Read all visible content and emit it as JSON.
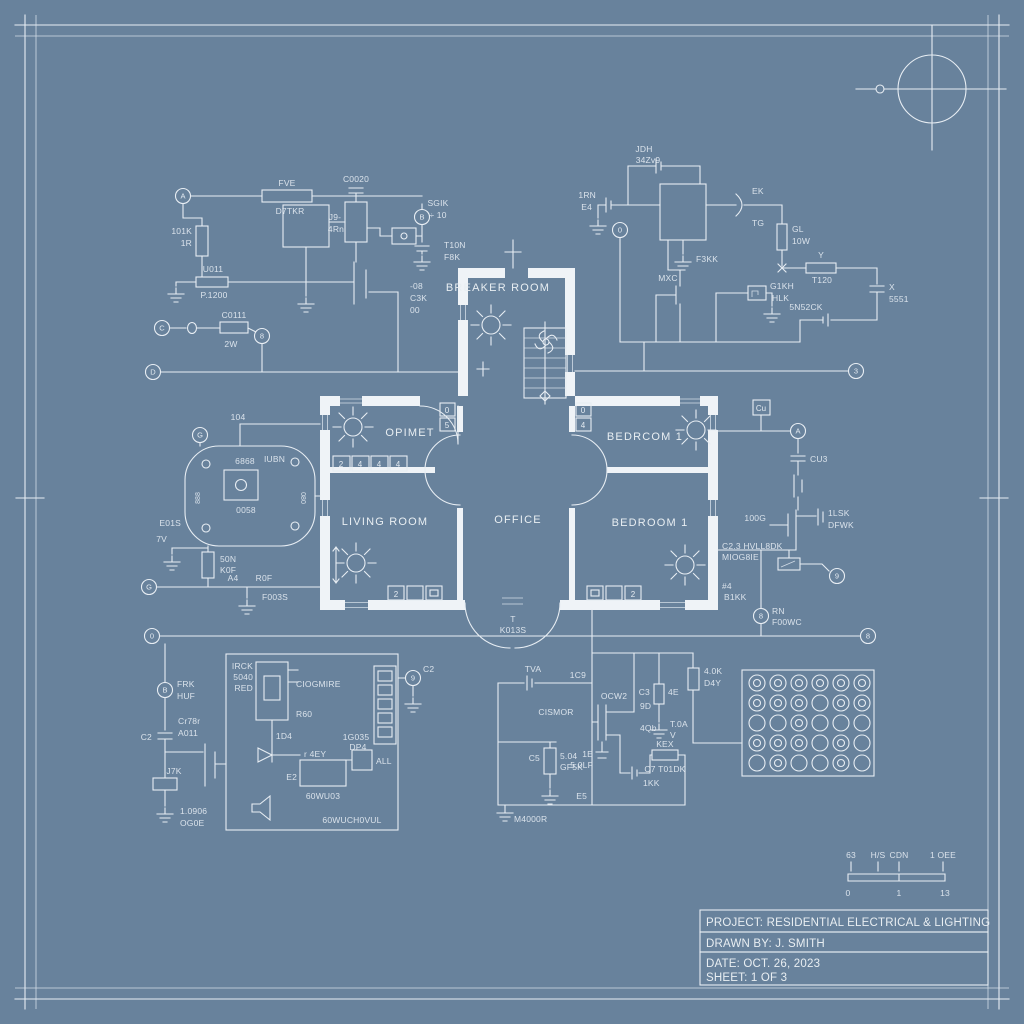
{
  "colors": {
    "background": "#68829C",
    "line": "#E7EDF3",
    "wall_fill": "#EFF3F7",
    "text": "#E4EBF2"
  },
  "title_block": {
    "project": "PROJECT: RESIDENTIAL ELECTRICAL & LIGHTING",
    "drawn_by": "DRAWN BY: J. SMITH",
    "date": "DATE: OCT. 26, 2023",
    "sheet": "SHEET: 1 OF 3"
  },
  "rooms": {
    "breaker_room": "BREAKER ROOM",
    "closet": "OPIMET",
    "bedroom_top": "BEDRCOM 1",
    "living_room": "LIVING ROOM",
    "office": "OFFICE",
    "bedroom_bottom": "BEDROOM 1",
    "entry_tag": "T",
    "entry_code": "K013S"
  },
  "scale_bar": {
    "top_labels": [
      "63",
      "H/S",
      "CDN",
      "1 OEE"
    ],
    "bottom_labels": [
      "0",
      "1",
      "13"
    ]
  },
  "terminals": {
    "tl_a": "A",
    "tl_out": "B",
    "tl_c": "C",
    "tl_b": "8",
    "bus1_left": "D",
    "bus1_right": "3",
    "tr_top": "0",
    "device": "G",
    "bus2_left": "G",
    "bus3_left": "0",
    "bus3_right": "8",
    "rt_top": "A",
    "rt_mid": "9",
    "rt_low": "8",
    "bl_main": "B",
    "bl_c2": "9"
  },
  "circuits": {
    "top_left": {
      "r1": "FVE",
      "r1b": "D7TKR",
      "c1": "C0020",
      "r2": "101K",
      "r2b": "1R",
      "q1": "J9-",
      "q1b": "4Rn",
      "out": "SGIK",
      "outb": "÷ 10",
      "bat": "T10N",
      "batb": "F8K",
      "ic": "-08",
      "icb": "C3K",
      "icc": "00",
      "r3": "U011",
      "r3b": "P.1200",
      "r4": "C0111",
      "r4b": "2W"
    },
    "top_right": {
      "c1": "JDH",
      "c1b": "34Zv9",
      "bat": "1RN",
      "batb": "E4",
      "d1": "EK",
      "d1b": "TG",
      "gnd": "F3KK",
      "r1": "GL",
      "r1b": "10W",
      "q1": "MXC",
      "g1": "G1KH",
      "g1b": "HLK",
      "r2": "Y",
      "r2b": "T120",
      "c2": "X",
      "c2b": "5551",
      "bat2": "5N52CK"
    },
    "device": {
      "top": "104",
      "n1": "6868",
      "n2": "IUBN",
      "n3": "0058",
      "side_l": "888",
      "side_r": "080",
      "e1": "E01S",
      "e2": "7V",
      "r1": "50N",
      "r1b": "K0F"
    },
    "bus2": {
      "a": "A4",
      "b": "R0F",
      "c": "F003S"
    },
    "bottom_left": {
      "t1": "FRK",
      "t1b": "HUF",
      "c1": "C2",
      "c1b": "Cr78r",
      "c1c": "A011",
      "r1": "J7K",
      "v1": "1.0906",
      "v1b": "OG0E",
      "m1": "IRCK",
      "m1b": "5040",
      "m1c": "RED",
      "m2": "CIOGMIRE",
      "m3": "R60",
      "m4": "1D4",
      "m5": "1G035",
      "m5b": "DP4",
      "m6": "ALL",
      "m7": "r 4EY",
      "m8": "E2",
      "m9": "60WU03",
      "m10": "60WUCH0VUL",
      "t2": "C2"
    },
    "bottom_mid": {
      "b1": "TVA",
      "n1": "1C9",
      "q1": "OCW2",
      "q1b": "CISMOR",
      "q1c": "9D",
      "q1d": "4Qb",
      "r1": "C3",
      "r1b": "4E",
      "g1": "T.0A",
      "g1b": "V",
      "r2": "C5",
      "r2b": "5.04",
      "r2c": "GF5K",
      "c1": "1E",
      "c1b": "5.0LF",
      "r3": "KEX",
      "r3b": "C7 T01DK",
      "bat": "1KK",
      "n2": "E5",
      "v1": "M4000R",
      "r4": "4.0K",
      "r4b": "D4Y"
    },
    "right": {
      "box": "Cu",
      "c1": "CU3",
      "g1": "100G",
      "c2": "1LSK",
      "c2b": "DFWK",
      "note1": "C2.3 HVLL8DK",
      "note2": "MIOG8IE",
      "note3": "#4",
      "note4": "B1KK",
      "t1": "RN",
      "t1b": "F00WC"
    }
  },
  "wall_fixtures": {
    "switch_bank": [
      "2",
      "4",
      "4",
      "4"
    ],
    "w1_boxes": [
      "0",
      "5"
    ],
    "w2_boxes": [
      "0",
      "4"
    ],
    "living_outlet": "2",
    "bedroom_outlet": "2",
    "rt_box": "Cu"
  }
}
